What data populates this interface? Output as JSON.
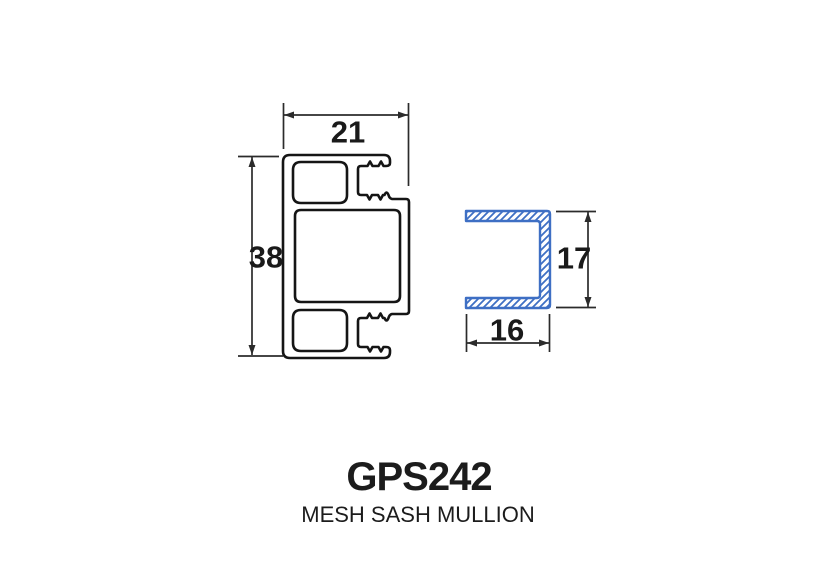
{
  "title": {
    "code": "GPS242",
    "name": "MESH SASH MULLION"
  },
  "dimensions": {
    "mullion_width": "21",
    "mullion_height": "38",
    "channel_height": "17",
    "channel_width": "16"
  },
  "colors": {
    "profile_line": "#151515",
    "channel_blue": "#3e6fc4",
    "dimension_line": "#2b2b2b",
    "background": "#ffffff"
  }
}
